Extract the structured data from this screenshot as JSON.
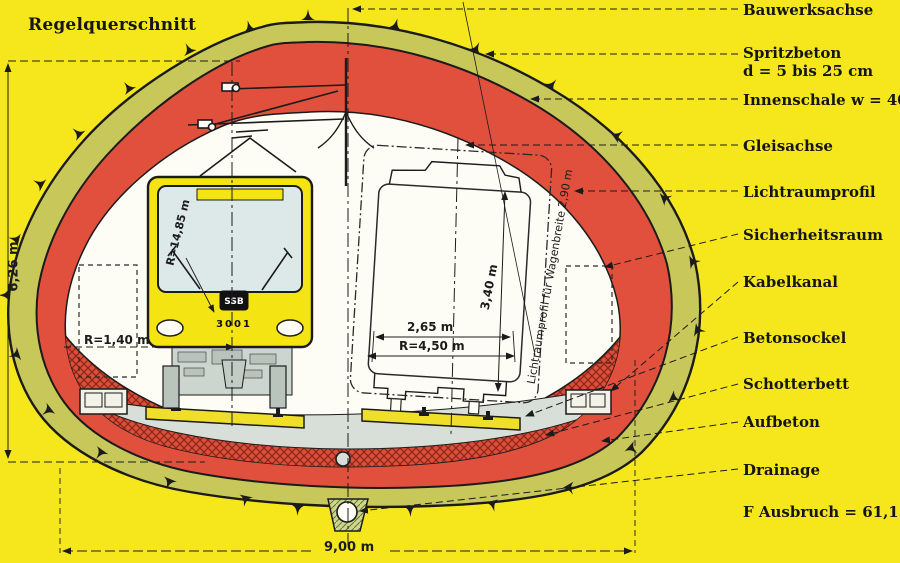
{
  "title": "Regelquerschnitt",
  "colors": {
    "background": "#f6e71d",
    "spritzbeton_band": "#c7c75a",
    "innenschale_red": "#e0503c",
    "tram_yellow": "#f4e412",
    "window_blue": "#dde8e8",
    "ballast_gray": "#d8dfd8",
    "line_black": "#1b1b1b"
  },
  "labels": {
    "bauwerksachse": "Bauwerksachse",
    "spritzbeton": "Spritzbeton",
    "spritzbeton_d": "d = 5 bis 25 cm",
    "innenschale": "Innenschale w = 40 cm",
    "gleisachse": "Gleisachse",
    "lichtraumprofil": "Lichtraumprofil",
    "sicherheitsraum": "Sicherheitsraum",
    "kabelkanal": "Kabelkanal",
    "betonsockel": "Betonsockel",
    "schotterbett": "Schotterbett",
    "aufbeton": "Aufbeton",
    "drainage": "Drainage",
    "ausbruch": "F Ausbruch = 61,15 m²"
  },
  "dimensions": {
    "tunnel_height": "6,26 m",
    "tunnel_width": "9,00 m",
    "floor_radius": "R=1,40 m",
    "windshield_radius": "R=14,85 m",
    "car_width": "2,65 m",
    "profile_radius": "R=4,50 m",
    "car_height": "3,40 m",
    "clearance_note": "Lichtraumprofil für Wagenbreite 2,90 m"
  },
  "tram": {
    "operator_logo": "SSB",
    "car_number": "3001"
  }
}
